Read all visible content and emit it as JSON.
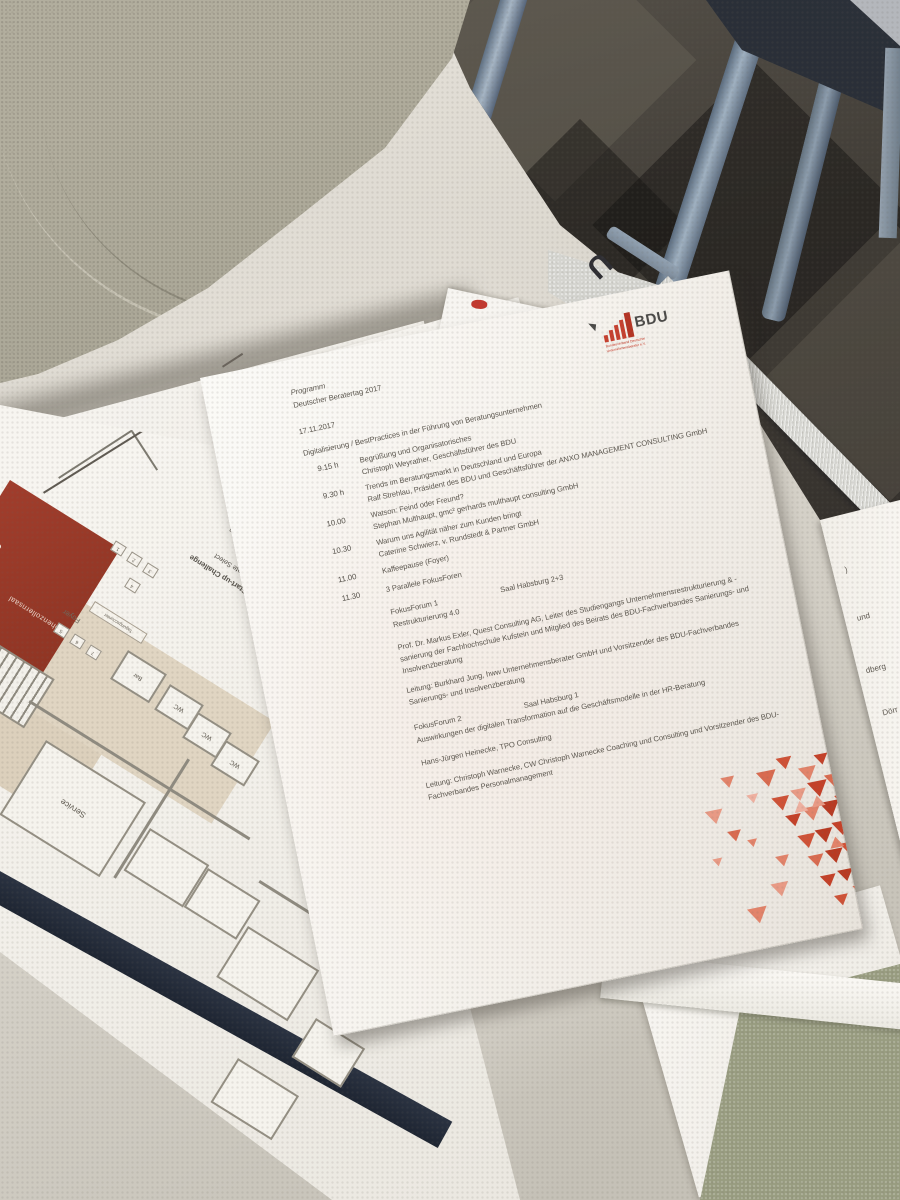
{
  "colors": {
    "accent_red": "#c6402f",
    "logo_gray": "#4b4a48",
    "hall_red": "#9c3a2a",
    "navy_band": "#262d3a",
    "triangle_palette": [
      "#eeb0a0",
      "#e89a85",
      "#e2836a",
      "#d96b50",
      "#cf5237",
      "#c44129",
      "#b83a22"
    ]
  },
  "logo": {
    "name": "BDU",
    "tagline_l1": "Bundesverband Deutscher",
    "tagline_l2": "Unternehmensberater e.V."
  },
  "program": {
    "kicker": "Programm",
    "title": "Deutscher Beratertag 2017",
    "date": "17.11.2017",
    "subtitle": "Digitalisierung / BestPractices in der Führung von Beratungsunternehmen",
    "sessions": [
      {
        "time": "9.15 h",
        "topic": "Begrüßung und Organisatorisches",
        "speaker": "Christoph Weyrather, Geschäftsführer des BDU"
      },
      {
        "time": "9.30 h",
        "topic": "Trends im Beratungsmarkt in Deutschland und Europa",
        "speaker": "Ralf Strehlau, Präsident des BDU und Geschäftsführer der ANXO MANAGEMENT CONSULTING GmbH"
      },
      {
        "time": "10.00",
        "topic": "Watson: Feind oder Freund?",
        "speaker": "Stephan Multhaupt, gmc² gerhards multhaupt consulting GmbH"
      },
      {
        "time": "10.30",
        "topic": "Warum uns Agilität näher zum Kunden bringt",
        "speaker": "Caterine Schwierz, v. Rundstedt & Partner GmbH"
      },
      {
        "time": "11.00",
        "topic": "Kaffeepause (Foyer)",
        "speaker": ""
      },
      {
        "time": "11.30",
        "topic": "3 Parallele FokusForen",
        "speaker": ""
      }
    ],
    "forum1": {
      "label": "FokusForum 1",
      "room": "Saal Habsburg 2+3",
      "topic": "Restrukturierung 4.0",
      "speaker_l1": "Prof. Dr. Markus Exler, Quest Consulting AG, Leiter des Studiengangs Unternehmensrestrukturierung & -",
      "speaker_l2": "sanierung der Fachhochschule Kufstein und Mitglied des Beirats des BDU-Fachverbandes Sanierungs- und",
      "speaker_l3": "Insolvenzberatung",
      "lead_l1": "Leitung: Burkhard Jung, hww Unternehmensberater GmbH und Vorsitzender des BDU-Fachverbandes",
      "lead_l2": "Sanierungs- und Insolvenzberatung"
    },
    "forum2": {
      "label": "FokusForum 2",
      "room": "Saal Habsburg 1",
      "topic": "Auswirkungen der digitalen Transformation auf die Geschäftsmodelle in der HR-Beratung",
      "speaker": "Hans-Jürgen Heinecke, TPO Consulting",
      "lead_l1": "Leitung: Christoph Warnecke, CW Christoph Warnecke Coaching und Consulting und Vorsitzender des BDU-",
      "lead_l2": "Fachverbandes Personalmanagement"
    }
  },
  "floorplan": {
    "challenge_title": "BDU-Start-up Challenge",
    "challenge_items": [
      "12: Candidate Select",
      "13: Lana Labs",
      "14: Zukunfts Agenten"
    ],
    "hall": "Hohenzollernsaal",
    "foyer": "Foyer",
    "counter": "Tagungscounter",
    "service": "Service",
    "bar": "Bar",
    "wc": "WC",
    "stands": [
      "1",
      "2",
      "3",
      "4",
      "5",
      "6",
      "7"
    ],
    "p_label": "P"
  },
  "under_sheet_fragments": {
    "f1": ")",
    "f2": "und",
    "f3": "dberg",
    "f4": "Dörr"
  },
  "brochure": {
    "big_letter": "U"
  }
}
